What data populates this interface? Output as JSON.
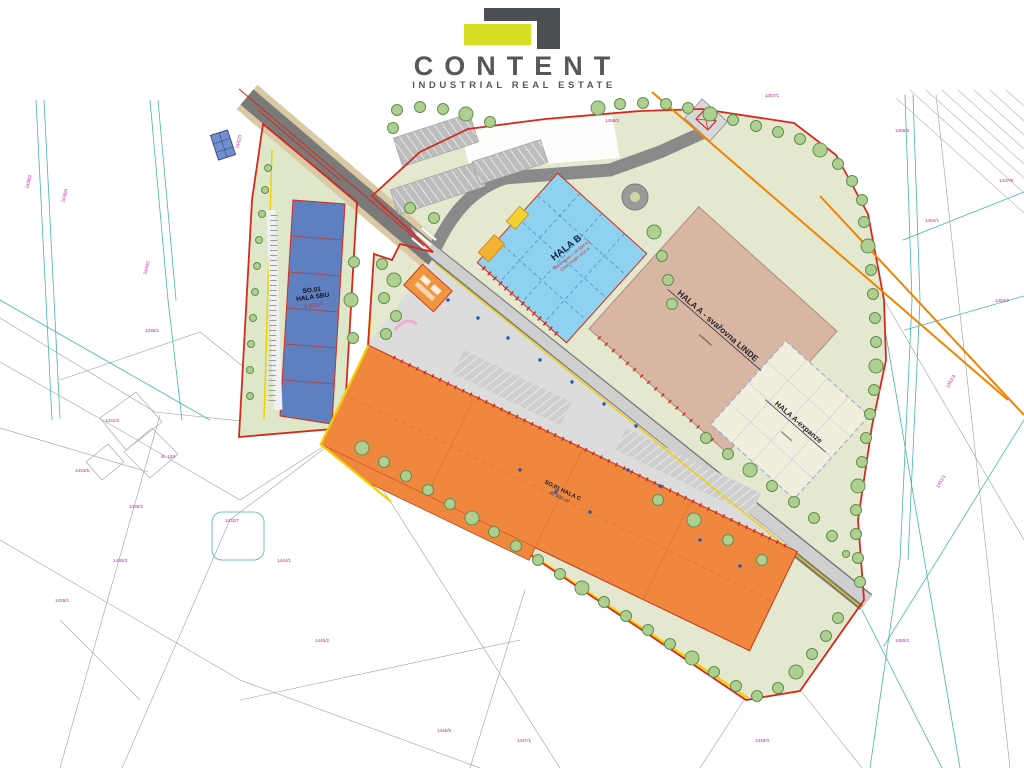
{
  "logo": {
    "name": "CONTENT",
    "tagline": "INDUSTRIAL REAL ESTATE"
  },
  "plan": {
    "buildings": {
      "hala_sbu": {
        "line1": "SO.01",
        "line2": "HALA SBU",
        "area": "8 360 m²",
        "color": "#5e7fc0"
      },
      "hala_b": {
        "label": "HALA B",
        "note1": "Warehouse = 10 500 m2",
        "note2": "Clear height 10,5 m",
        "color": "#8fd2f0"
      },
      "hala_a": {
        "label": "HALA A - svařovna LINDE",
        "color": "#d9b5a4"
      },
      "hala_a_exp": {
        "label": "HALA A-expanze",
        "color": "#f2eedd"
      },
      "hala_c": {
        "label": "SO.01 HALA C",
        "area": "30 500 m²",
        "color": "#f0873f"
      }
    },
    "colors": {
      "boundary_red": "#d42a1e",
      "marking_yellow": "#f2cf00",
      "utility_orange": "#f08300",
      "cadastre_teal": "#45b5ae",
      "parcel_magenta": "#c818a0"
    },
    "parcel_labels": [
      {
        "t": "1438/2",
        "x": 30,
        "y": 182,
        "r": -75
      },
      {
        "t": "1438/4",
        "x": 66,
        "y": 196,
        "r": -75
      },
      {
        "t": "1440/1",
        "x": 148,
        "y": 268,
        "r": -75
      },
      {
        "t": "1442/3",
        "x": 240,
        "y": 142,
        "r": -75
      },
      {
        "t": "1435/1",
        "x": 152,
        "y": 332,
        "r": 0
      },
      {
        "t": "1431/2",
        "x": 112,
        "y": 422,
        "r": 0
      },
      {
        "t": "1433/5",
        "x": 82,
        "y": 472,
        "r": 0
      },
      {
        "t": "st. 128",
        "x": 168,
        "y": 458,
        "r": 0
      },
      {
        "t": "1436/2",
        "x": 136,
        "y": 508,
        "r": 0
      },
      {
        "t": "1432/7",
        "x": 232,
        "y": 522,
        "r": 0
      },
      {
        "t": "1444/1",
        "x": 284,
        "y": 562,
        "r": 0
      },
      {
        "t": "1430/3",
        "x": 120,
        "y": 562,
        "r": 0
      },
      {
        "t": "1429/1",
        "x": 62,
        "y": 602,
        "r": 0
      },
      {
        "t": "1445/2",
        "x": 322,
        "y": 642,
        "r": 0
      },
      {
        "t": "1446/5",
        "x": 444,
        "y": 732,
        "r": 0
      },
      {
        "t": "1447/1",
        "x": 524,
        "y": 742,
        "r": 0
      },
      {
        "t": "1448/3",
        "x": 762,
        "y": 742,
        "r": 0
      },
      {
        "t": "1450/2",
        "x": 902,
        "y": 642,
        "r": 0
      },
      {
        "t": "1451/1",
        "x": 942,
        "y": 482,
        "r": -60
      },
      {
        "t": "1452/4",
        "x": 952,
        "y": 382,
        "r": -60
      },
      {
        "t": "1453/2",
        "x": 1002,
        "y": 302,
        "r": 0
      },
      {
        "t": "1454/1",
        "x": 932,
        "y": 222,
        "r": 0
      },
      {
        "t": "1455/3",
        "x": 902,
        "y": 132,
        "r": 0
      },
      {
        "t": "1437/8",
        "x": 1006,
        "y": 182,
        "r": 0
      },
      {
        "t": "1456/2",
        "x": 612,
        "y": 122,
        "r": 0
      },
      {
        "t": "1457/1",
        "x": 772,
        "y": 97,
        "r": 0
      }
    ]
  }
}
